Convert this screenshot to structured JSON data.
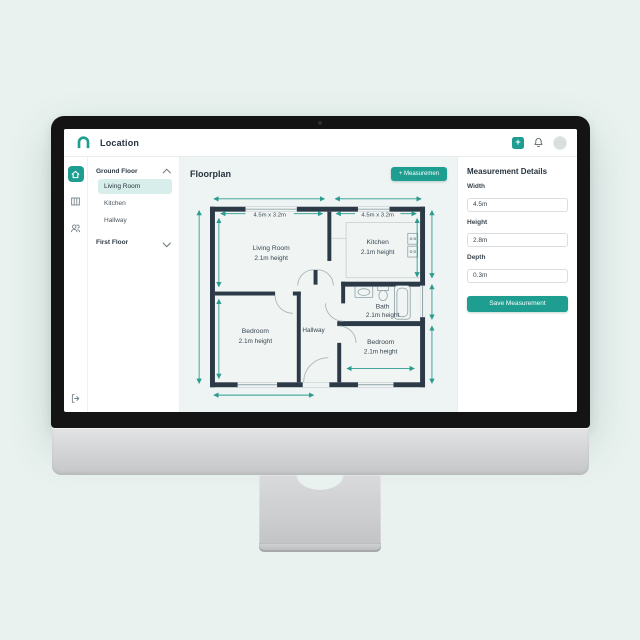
{
  "header": {
    "title": "Location",
    "add_button": "+"
  },
  "nav": {
    "ground_floor_label": "Ground Floor",
    "rooms": [
      {
        "label": "Living Room"
      },
      {
        "label": "Kitchen"
      },
      {
        "label": "Hallway"
      }
    ],
    "first_floor_label": "First Floor"
  },
  "main": {
    "title": "Floorplan",
    "measurement_button": "+ Measuremen"
  },
  "floorplan": {
    "dimension_labels": [
      "4.5m x 3.2m",
      "4.5m x 3.2m"
    ],
    "rooms": [
      {
        "name": "Living Room",
        "detail": "2.1m height"
      },
      {
        "name": "Kitchen",
        "detail": "2.1m height"
      },
      {
        "name": "Bath",
        "detail": "2.1m height"
      },
      {
        "name": "Bedroom",
        "detail": "2.1m height"
      },
      {
        "name": "Hallway",
        "detail": ""
      },
      {
        "name": "Bedroom",
        "detail": "2.1m height"
      }
    ]
  },
  "details_panel": {
    "title": "Measurement Details",
    "fields": [
      {
        "label": "Width",
        "value": "4.5m"
      },
      {
        "label": "Height",
        "value": "2.8m"
      },
      {
        "label": "Depth",
        "value": "0.3m"
      }
    ],
    "save_button": "Save Measurement"
  },
  "colors": {
    "accent": "#1d9e90",
    "accent_light": "#d8eeea",
    "wall": "#2c3947",
    "dimension": "#2a9c8e",
    "page_background": "#e9f2ef"
  }
}
